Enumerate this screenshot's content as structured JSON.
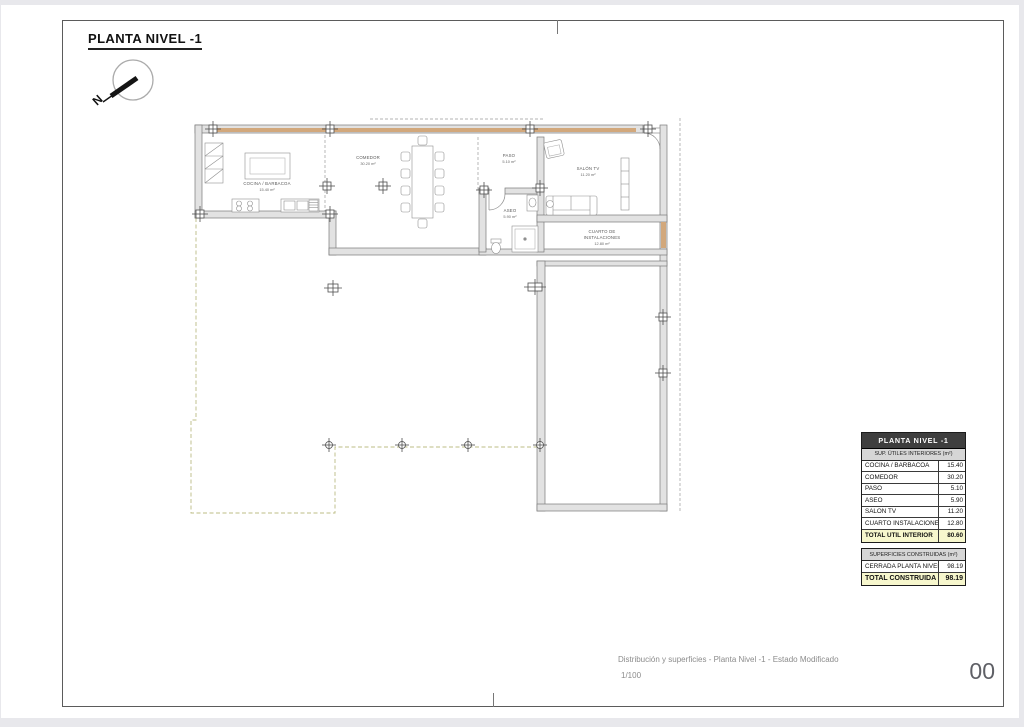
{
  "sheet": {
    "title": "PLANTA NIVEL -1",
    "north_label": "N"
  },
  "plan": {
    "rooms": [
      {
        "name": "COCINA / BARBACOA",
        "area": "15.40 m²"
      },
      {
        "name": "COMEDOR",
        "area": "30.20 m²"
      },
      {
        "name": "PASO",
        "area": "5.10 m²"
      },
      {
        "name": "SALÓN TV",
        "area": "11.20 m²"
      },
      {
        "name": "ASEO",
        "area": "5.90 m²"
      },
      {
        "name": "CUARTO DE",
        "name2": "INSTALACIONES",
        "area": "12.80 m²"
      }
    ]
  },
  "tables": {
    "interior": {
      "title": "PLANTA NIVEL -1",
      "subtitle": "SUP. ÚTILES INTERIORES (m²)",
      "rows": [
        {
          "label": "COCINA / BARBACOA",
          "value": "15.40"
        },
        {
          "label": "COMEDOR",
          "value": "30.20"
        },
        {
          "label": "PASO",
          "value": "5.10"
        },
        {
          "label": "ASEO",
          "value": "5.90"
        },
        {
          "label": "SALÓN TV",
          "value": "11.20"
        },
        {
          "label": "CUARTO INSTALACIONES",
          "value": "12.80"
        }
      ],
      "total_label": "TOTAL ÚTIL INTERIOR",
      "total_value": "80.60"
    },
    "built": {
      "subtitle": "SUPERFICIES CONSTRUIDAS (m²)",
      "rows": [
        {
          "label": "CERRADA PLANTA NIVEL -1",
          "value": "98.19"
        }
      ],
      "total_label": "TOTAL CONSTRUIDA",
      "total_value": "98.19"
    }
  },
  "footer": {
    "description": "Distribución y superficies - Planta Nivel -1 - Estado Modificado",
    "scale": "1/100",
    "sheet_number": "00"
  }
}
